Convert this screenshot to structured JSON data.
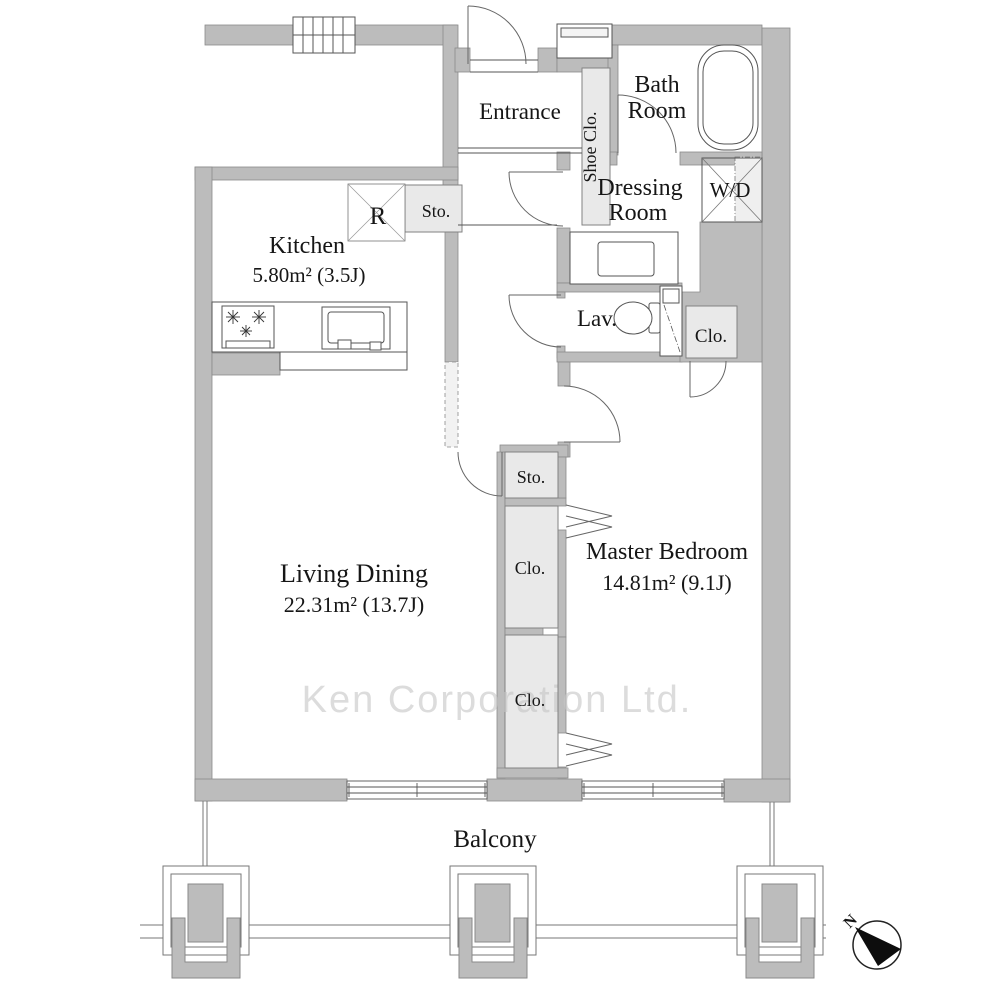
{
  "rooms": {
    "entrance": {
      "label": "Entrance"
    },
    "shoe_closet": {
      "label": "Shoe Clo."
    },
    "bath_room": {
      "line1": "Bath",
      "line2": "Room"
    },
    "dressing_room": {
      "line1": "Dressing",
      "line2": "Room"
    },
    "washer_dryer": {
      "label": "W/D"
    },
    "lavatory": {
      "label": "Lav."
    },
    "closet_by_lavatory": {
      "label": "Clo."
    },
    "kitchen": {
      "label": "Kitchen",
      "area": "5.80m²  (3.5J)"
    },
    "hall_storage": {
      "label": "Sto."
    },
    "refrigerator": {
      "label": "R"
    },
    "living_dining": {
      "label": "Living Dining",
      "area": "22.31m²  (13.7J)"
    },
    "center_storage": {
      "label": "Sto."
    },
    "closet_upper": {
      "label": "Clo."
    },
    "closet_lower": {
      "label": "Clo."
    },
    "master_bedroom": {
      "label": "Master Bedroom",
      "area": "14.81m²  (9.1J)"
    },
    "balcony": {
      "label": "Balcony"
    }
  },
  "compass": {
    "north_label": "N"
  },
  "watermark": {
    "text": "Ken Corporation Ltd."
  },
  "colors": {
    "wall": "#bcbcbc",
    "wall_outline": "#8a8a8a",
    "closet_fill": "#e9e9e9",
    "line": "#4d4d4d",
    "text": "#161616",
    "watermark": "#c6c6c6"
  }
}
